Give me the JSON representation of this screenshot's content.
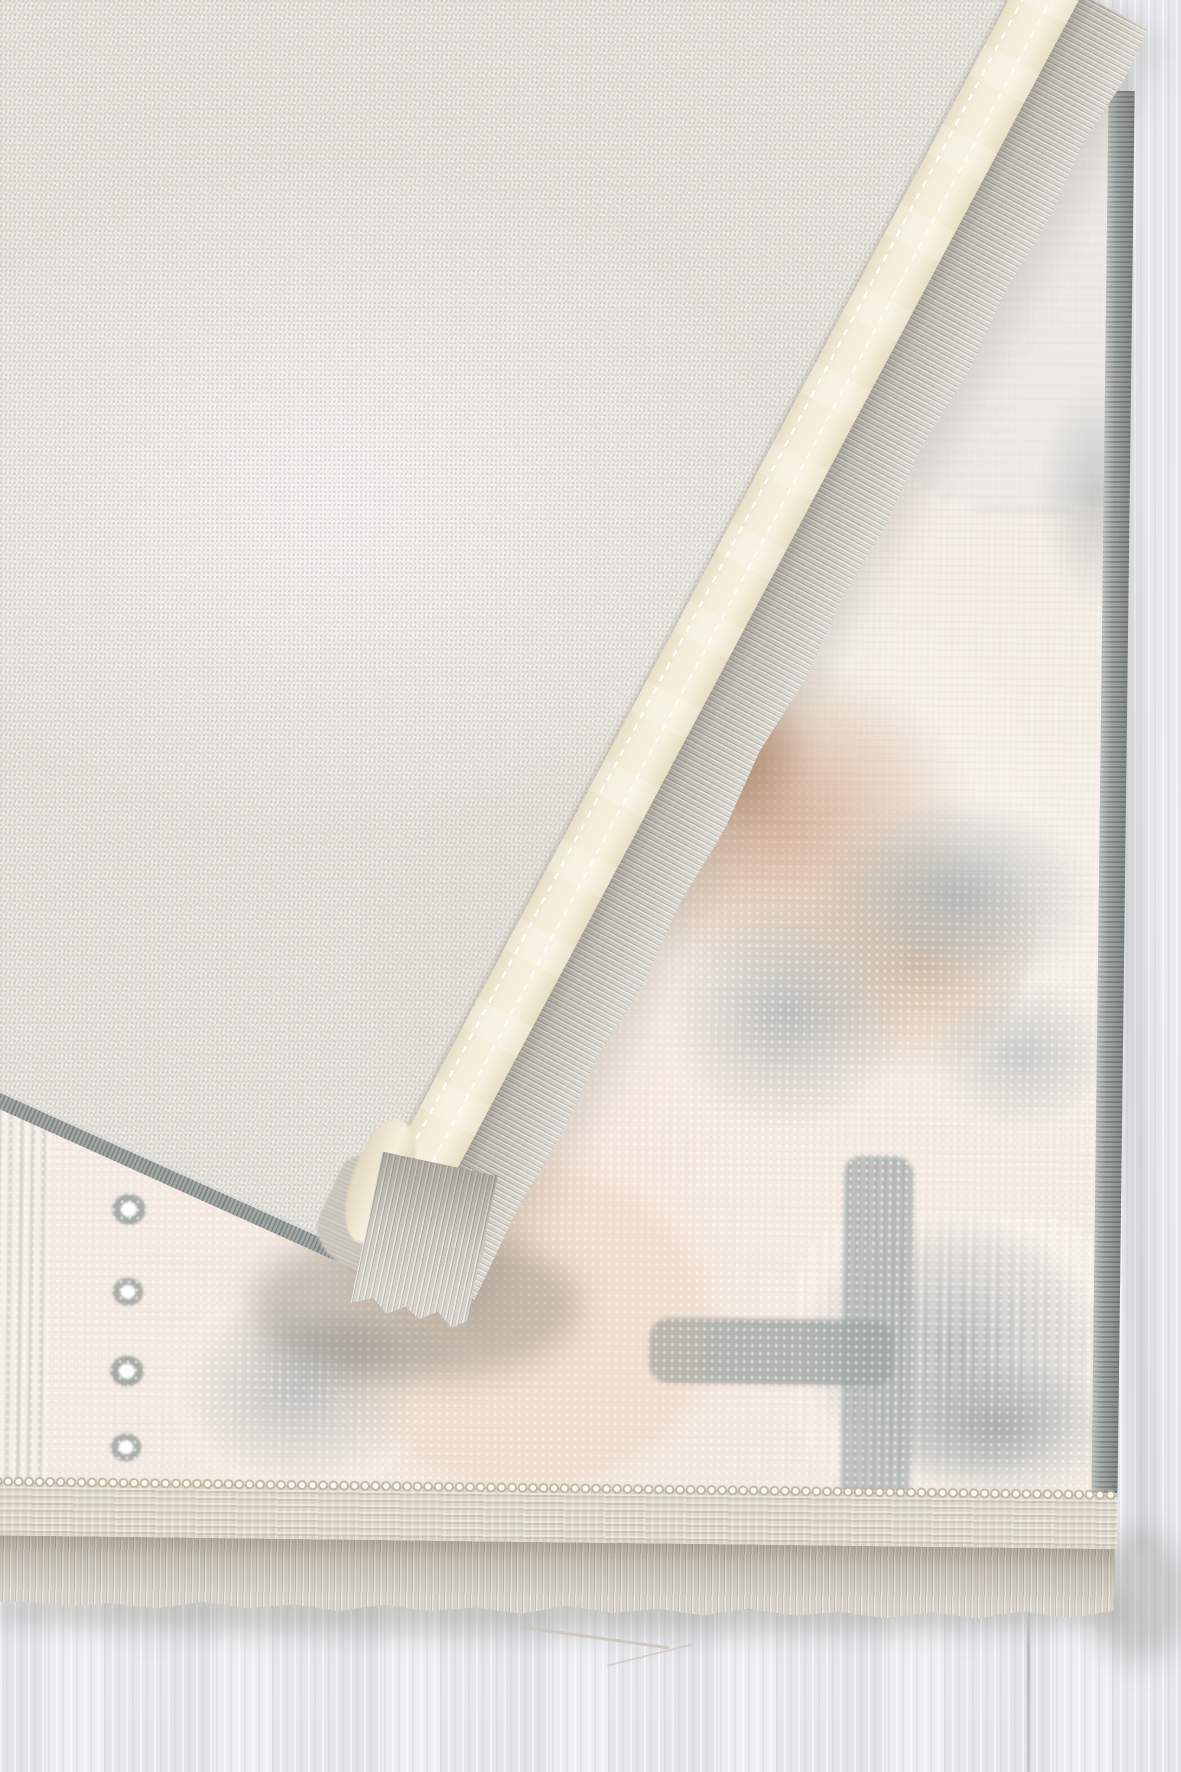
{
  "scene": {
    "description": "Close-up product photograph of a cream abstract-pattern area rug with its corner folded over, revealing the woven canvas backing, cream binding tape and grey fringe; the rug lies on a whitewashed wood-plank floor",
    "objects": [
      "rug front face with distressed grey and tan abstract pattern",
      "folded-over corner showing canvas backing",
      "cream binding tape with white stitch lines",
      "grey overlock serged edges",
      "flat-woven beige end band with loop row",
      "fringe tassels",
      "whitewashed wood floor with plank seam"
    ]
  },
  "palette": {
    "floor_base": "#e9ebed",
    "floor_streak_light": "#f6f7f8",
    "floor_streak_dark": "#d9dcdf",
    "floor_seam": "#c7cacd",
    "backing_base": "#e7e4de",
    "backing_dot": "#c9c3bb",
    "binding_cream": "#f3ecd9",
    "binding_shadow": "#ded5bc",
    "serge_grey": "#a2a8a6",
    "serge_dark": "#7e8482",
    "fringe_base": "#cac6be",
    "fringe_dark": "#a8a49b",
    "fringe_light": "#e6e3dc",
    "rug_base": "#f5ede5",
    "rug_cream": "#efe3d6",
    "pattern_grey": "#b1b8b6",
    "pattern_grey_light": "#cdd3d1",
    "pattern_tan": "#c49c7e",
    "pattern_tan_light": "#d7b99d",
    "pile_white": "#faf7f2",
    "band_beige": "#dbd4c5",
    "band_ridge": "#c6bfae",
    "shadow": "#8d897f"
  }
}
